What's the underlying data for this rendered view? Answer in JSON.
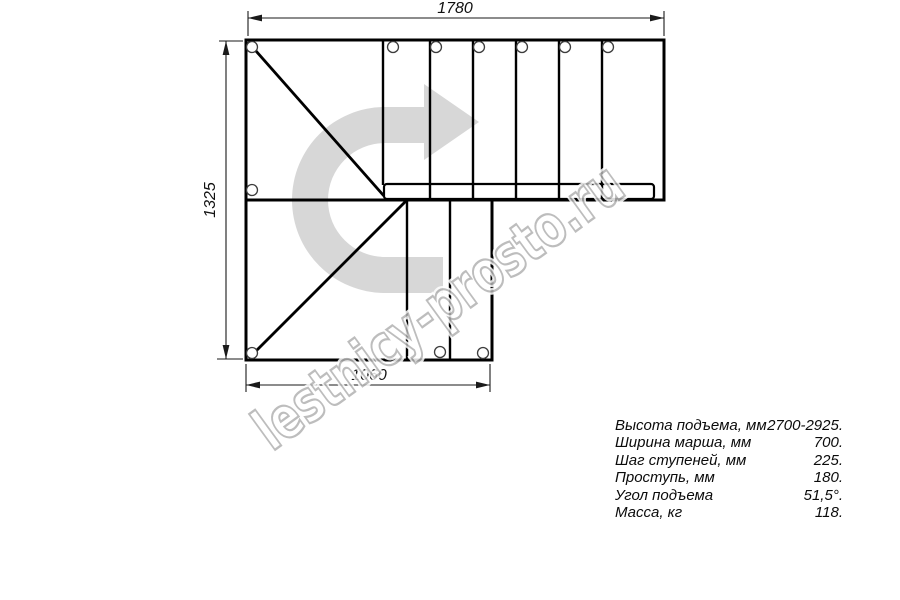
{
  "drawing": {
    "title": "staircase-plan-top-view",
    "dim_top": "1780",
    "dim_left": "1325",
    "dim_bottom": "1060",
    "watermark": "lestnicy-prosto.ru",
    "colors": {
      "line": "#000000",
      "dimension_line": "#1a1a1a",
      "direction_arrow_fill": "#d7d7d7",
      "watermark_stroke": "#b2b2b2"
    }
  },
  "specs": {
    "rows": [
      {
        "label": "Высота подъема, мм",
        "value": "2700-2925."
      },
      {
        "label": "Ширина марша, мм",
        "value": "700."
      },
      {
        "label": "Шаг ступеней, мм",
        "value": "225."
      },
      {
        "label": "Проступь, мм",
        "value": "180."
      },
      {
        "label": "Угол подъема",
        "value": "51,5°."
      },
      {
        "label": "Масса, кг",
        "value": "118."
      }
    ]
  }
}
